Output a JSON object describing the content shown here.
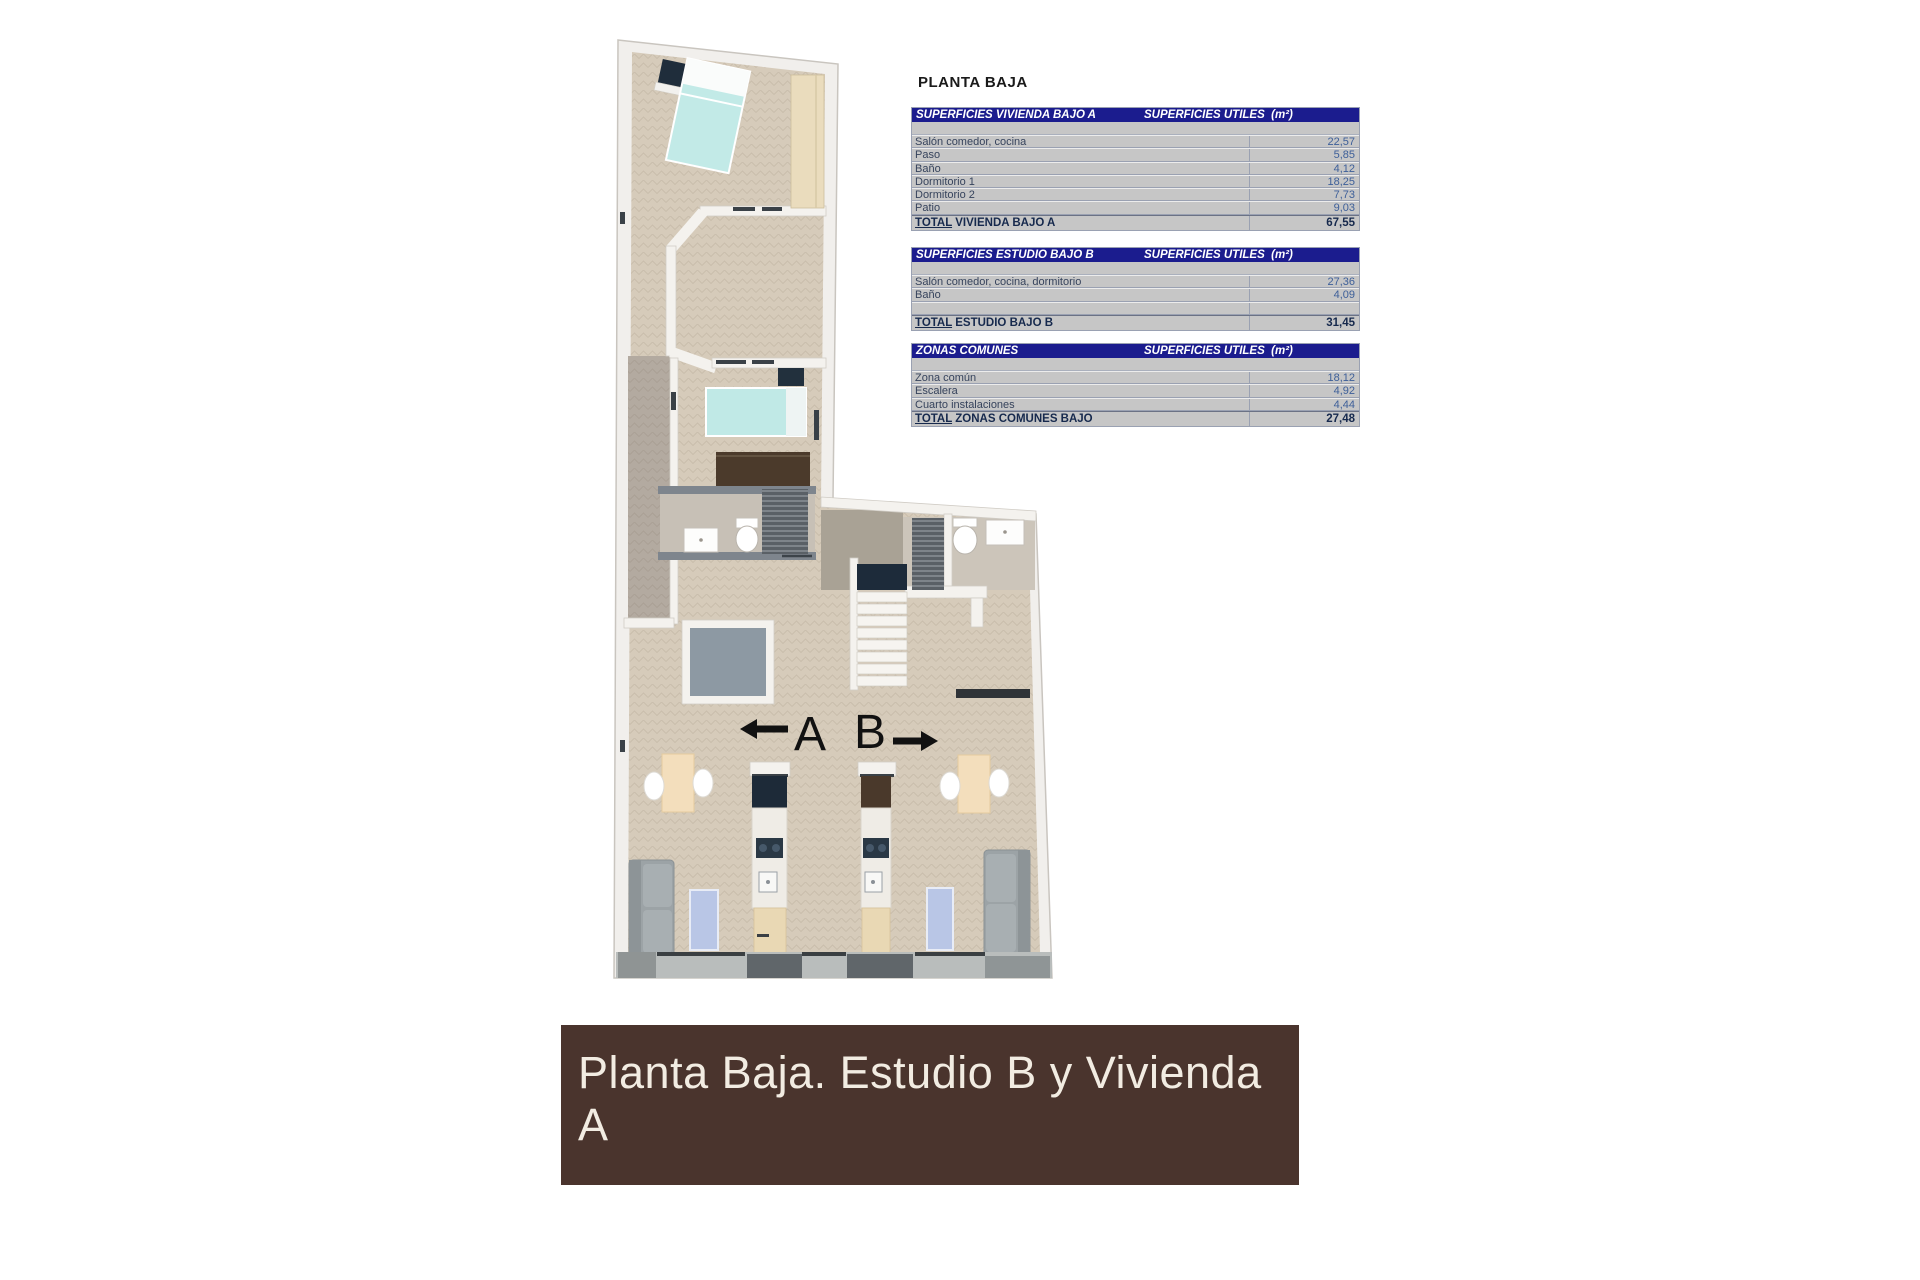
{
  "summary": {
    "title": "PLANTA BAJA",
    "tables": [
      {
        "header_left": "SUPERFICIES VIVIENDA BAJO A",
        "header_right": "SUPERFICIES UTILES  (m²)",
        "rows": [
          {
            "label": "Salón comedor, cocina",
            "value": "22,57"
          },
          {
            "label": "Paso",
            "value": "5,85"
          },
          {
            "label": "Baño",
            "value": "4,12"
          },
          {
            "label": "Dormitorio 1",
            "value": "18,25"
          },
          {
            "label": "Dormitorio 2",
            "value": "7,73"
          },
          {
            "label": "Patio",
            "value": "9,03"
          }
        ],
        "total_prefix": "TOTAL",
        "total_rest": " VIVIENDA BAJO A",
        "total_value": "67,55"
      },
      {
        "header_left": "SUPERFICIES ESTUDIO BAJO B",
        "header_right": "SUPERFICIES UTILES  (m²)",
        "rows": [
          {
            "label": "Salón comedor, cocina, dormitorio",
            "value": "27,36"
          },
          {
            "label": "Baño",
            "value": "4,09"
          },
          {
            "label": "",
            "value": ""
          }
        ],
        "total_prefix": "TOTAL",
        "total_rest": " ESTUDIO BAJO B",
        "total_value": "31,45"
      },
      {
        "header_left": "ZONAS COMUNES",
        "header_right": "SUPERFICIES UTILES  (m²)",
        "rows": [
          {
            "label": "Zona común",
            "value": "18,12"
          },
          {
            "label": "Escalera",
            "value": "4,92"
          },
          {
            "label": "Cuarto instalaciones",
            "value": "4,44"
          }
        ],
        "total_prefix": "TOTAL",
        "total_rest": " ZONAS COMUNES BAJO",
        "total_value": "27,48"
      }
    ]
  },
  "plan": {
    "label_a": "A",
    "label_b": "B"
  },
  "banner": {
    "text": "Planta Baja. Estudio B y Vivienda A",
    "background": "#4a342d",
    "text_color": "#f2ece2"
  },
  "colors": {
    "table_header": "#1b1c8e",
    "table_body": "#c6c6c6",
    "value_text": "#3d5f99",
    "floor_beige": "#d6cbba",
    "corridor_gray": "#b3aaa0",
    "patio_gray": "#8d99a3",
    "bed_teal": "#c2eae7",
    "wood": "#eadcbd"
  }
}
